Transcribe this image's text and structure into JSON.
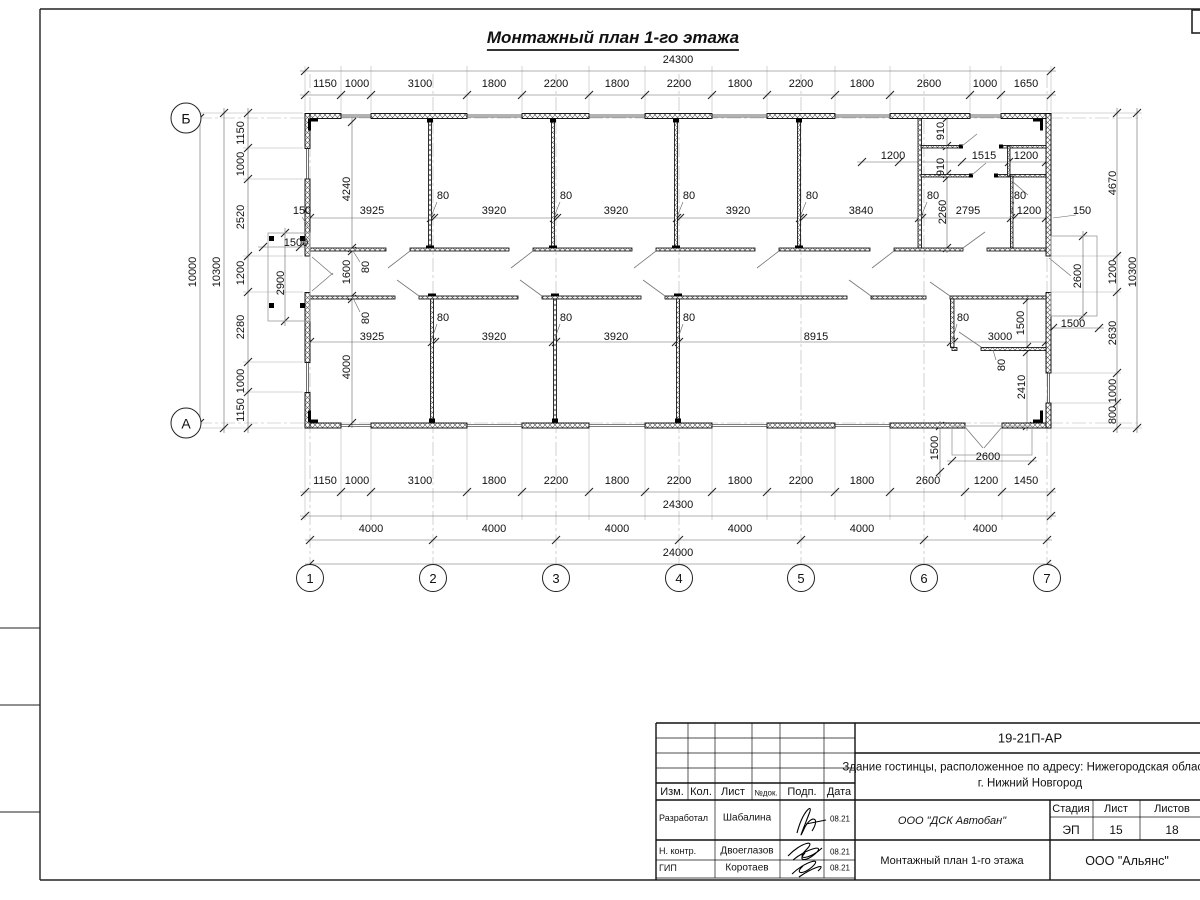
{
  "title": "Монтажный план 1-го этажа",
  "axes": {
    "bottom": [
      {
        "label": "1",
        "x": 310
      },
      {
        "label": "2",
        "x": 433
      },
      {
        "label": "3",
        "x": 556
      },
      {
        "label": "4",
        "x": 679
      },
      {
        "label": "5",
        "x": 801
      },
      {
        "label": "6",
        "x": 924
      },
      {
        "label": "7",
        "x": 1047
      }
    ],
    "left": [
      {
        "label": "Б",
        "y": 118
      },
      {
        "label": "А",
        "y": 423
      }
    ]
  },
  "dim_labels": [
    {
      "t": "24300",
      "x": 678,
      "y": 60,
      "r": 0
    },
    {
      "t": "1150",
      "x": 325,
      "y": 84,
      "r": 0
    },
    {
      "t": "1000",
      "x": 357,
      "y": 84,
      "r": 0
    },
    {
      "t": "3100",
      "x": 420,
      "y": 84,
      "r": 0
    },
    {
      "t": "1800",
      "x": 494,
      "y": 84,
      "r": 0
    },
    {
      "t": "2200",
      "x": 556,
      "y": 84,
      "r": 0
    },
    {
      "t": "1800",
      "x": 617,
      "y": 84,
      "r": 0
    },
    {
      "t": "2200",
      "x": 679,
      "y": 84,
      "r": 0
    },
    {
      "t": "1800",
      "x": 740,
      "y": 84,
      "r": 0
    },
    {
      "t": "2200",
      "x": 801,
      "y": 84,
      "r": 0
    },
    {
      "t": "1800",
      "x": 862,
      "y": 84,
      "r": 0
    },
    {
      "t": "2600",
      "x": 929,
      "y": 84,
      "r": 0
    },
    {
      "t": "1000",
      "x": 985,
      "y": 84,
      "r": 0
    },
    {
      "t": "1650",
      "x": 1026,
      "y": 84,
      "r": 0
    },
    {
      "t": "1150",
      "x": 325,
      "y": 481,
      "r": 0
    },
    {
      "t": "1000",
      "x": 357,
      "y": 481,
      "r": 0
    },
    {
      "t": "3100",
      "x": 420,
      "y": 481,
      "r": 0
    },
    {
      "t": "1800",
      "x": 494,
      "y": 481,
      "r": 0
    },
    {
      "t": "2200",
      "x": 556,
      "y": 481,
      "r": 0
    },
    {
      "t": "1800",
      "x": 617,
      "y": 481,
      "r": 0
    },
    {
      "t": "2200",
      "x": 679,
      "y": 481,
      "r": 0
    },
    {
      "t": "1800",
      "x": 740,
      "y": 481,
      "r": 0
    },
    {
      "t": "2200",
      "x": 801,
      "y": 481,
      "r": 0
    },
    {
      "t": "1800",
      "x": 862,
      "y": 481,
      "r": 0
    },
    {
      "t": "2600",
      "x": 928,
      "y": 481,
      "r": 0
    },
    {
      "t": "1200",
      "x": 986,
      "y": 481,
      "r": 0
    },
    {
      "t": "1450",
      "x": 1026,
      "y": 481,
      "r": 0
    },
    {
      "t": "24300",
      "x": 678,
      "y": 505,
      "r": 0
    },
    {
      "t": "4000",
      "x": 371,
      "y": 529,
      "r": 0
    },
    {
      "t": "4000",
      "x": 494,
      "y": 529,
      "r": 0
    },
    {
      "t": "4000",
      "x": 617,
      "y": 529,
      "r": 0
    },
    {
      "t": "4000",
      "x": 740,
      "y": 529,
      "r": 0
    },
    {
      "t": "4000",
      "x": 862,
      "y": 529,
      "r": 0
    },
    {
      "t": "4000",
      "x": 985,
      "y": 529,
      "r": 0
    },
    {
      "t": "24000",
      "x": 678,
      "y": 553,
      "r": 0
    },
    {
      "t": "1150",
      "x": 241,
      "y": 133,
      "r": 1
    },
    {
      "t": "1000",
      "x": 241,
      "y": 164,
      "r": 1
    },
    {
      "t": "2520",
      "x": 241,
      "y": 217,
      "r": 1
    },
    {
      "t": "1200",
      "x": 241,
      "y": 273,
      "r": 1
    },
    {
      "t": "2280",
      "x": 241,
      "y": 327,
      "r": 1
    },
    {
      "t": "1000",
      "x": 241,
      "y": 381,
      "r": 1
    },
    {
      "t": "1150",
      "x": 241,
      "y": 410,
      "r": 1
    },
    {
      "t": "10300",
      "x": 217,
      "y": 272,
      "r": 1
    },
    {
      "t": "10000",
      "x": 193,
      "y": 272,
      "r": 1
    },
    {
      "t": "4670",
      "x": 1113,
      "y": 183,
      "r": 1
    },
    {
      "t": "1200",
      "x": 1113,
      "y": 272,
      "r": 1
    },
    {
      "t": "2630",
      "x": 1113,
      "y": 333,
      "r": 1
    },
    {
      "t": "1000",
      "x": 1113,
      "y": 391,
      "r": 1
    },
    {
      "t": "800",
      "x": 1113,
      "y": 415,
      "r": 1
    },
    {
      "t": "10300",
      "x": 1133,
      "y": 272,
      "r": 1
    },
    {
      "t": "4240",
      "x": 347,
      "y": 189,
      "r": 1
    },
    {
      "t": "150",
      "x": 302,
      "y": 211,
      "r": 0
    },
    {
      "t": "3925",
      "x": 372,
      "y": 211,
      "r": 0
    },
    {
      "t": "80",
      "x": 443,
      "y": 196,
      "r": 0
    },
    {
      "t": "3920",
      "x": 494,
      "y": 211,
      "r": 0
    },
    {
      "t": "80",
      "x": 566,
      "y": 196,
      "r": 0
    },
    {
      "t": "3920",
      "x": 616,
      "y": 211,
      "r": 0
    },
    {
      "t": "80",
      "x": 689,
      "y": 196,
      "r": 0
    },
    {
      "t": "3920",
      "x": 738,
      "y": 211,
      "r": 0
    },
    {
      "t": "80",
      "x": 812,
      "y": 196,
      "r": 0
    },
    {
      "t": "3840",
      "x": 861,
      "y": 211,
      "r": 0
    },
    {
      "t": "80",
      "x": 933,
      "y": 196,
      "r": 0
    },
    {
      "t": "1200",
      "x": 893,
      "y": 156,
      "r": 0
    },
    {
      "t": "910",
      "x": 941,
      "y": 131,
      "r": 1
    },
    {
      "t": "910",
      "x": 941,
      "y": 167,
      "r": 1
    },
    {
      "t": "1515",
      "x": 984,
      "y": 156,
      "r": 0
    },
    {
      "t": "1200",
      "x": 1026,
      "y": 156,
      "r": 0
    },
    {
      "t": "2260",
      "x": 943,
      "y": 212,
      "r": 1
    },
    {
      "t": "2795",
      "x": 968,
      "y": 211,
      "r": 0
    },
    {
      "t": "80",
      "x": 1020,
      "y": 196,
      "r": 0
    },
    {
      "t": "1200",
      "x": 1029,
      "y": 211,
      "r": 0
    },
    {
      "t": "150",
      "x": 1082,
      "y": 211,
      "r": 0
    },
    {
      "t": "1500",
      "x": 296,
      "y": 243,
      "r": 0
    },
    {
      "t": "2900",
      "x": 281,
      "y": 283,
      "r": 1
    },
    {
      "t": "1600",
      "x": 347,
      "y": 272,
      "r": 1
    },
    {
      "t": "80",
      "x": 366,
      "y": 267,
      "r": 1
    },
    {
      "t": "80",
      "x": 366,
      "y": 318,
      "r": 1
    },
    {
      "t": "4000",
      "x": 347,
      "y": 367,
      "r": 1
    },
    {
      "t": "3925",
      "x": 372,
      "y": 337,
      "r": 0
    },
    {
      "t": "80",
      "x": 443,
      "y": 318,
      "r": 0
    },
    {
      "t": "3920",
      "x": 494,
      "y": 337,
      "r": 0
    },
    {
      "t": "80",
      "x": 566,
      "y": 318,
      "r": 0
    },
    {
      "t": "3920",
      "x": 616,
      "y": 337,
      "r": 0
    },
    {
      "t": "80",
      "x": 689,
      "y": 318,
      "r": 0
    },
    {
      "t": "8915",
      "x": 816,
      "y": 337,
      "r": 0
    },
    {
      "t": "80",
      "x": 963,
      "y": 318,
      "r": 0
    },
    {
      "t": "3000",
      "x": 1000,
      "y": 337,
      "r": 0
    },
    {
      "t": "1500",
      "x": 1021,
      "y": 323,
      "r": 1
    },
    {
      "t": "1500",
      "x": 1073,
      "y": 324,
      "r": 0
    },
    {
      "t": "2600",
      "x": 1078,
      "y": 276,
      "r": 1
    },
    {
      "t": "80",
      "x": 1002,
      "y": 365,
      "r": 1
    },
    {
      "t": "2410",
      "x": 1022,
      "y": 387,
      "r": 1
    },
    {
      "t": "2600",
      "x": 988,
      "y": 457,
      "r": 0
    },
    {
      "t": "1500",
      "x": 935,
      "y": 448,
      "r": 1
    }
  ],
  "title_block": {
    "doc_code": "19-21П-АР",
    "object_name": "Здание гостинцы, расположенное по адресу: Нижегородская область, г. Нижний Новгород",
    "col_izm": "Изм.",
    "col_kol": "Кол.",
    "col_list": "Лист",
    "col_doc": "№док.",
    "col_podp": "Подп.",
    "col_data": "Дата",
    "row1_role": "Разработал",
    "row1_name": "Шабалина",
    "row1_date": "08.21",
    "row2_role": "Н. контр.",
    "row2_name": "Двоеглазов",
    "row2_date": "08.21",
    "row3_role": "ГИП",
    "row3_name": "Коротаев",
    "row3_date": "08.21",
    "org": "ООО \"ДСК Автобан\"",
    "stage_label": "Стадия",
    "sheet_label": "Лист",
    "sheets_label": "Листов",
    "stage": "ЭП",
    "sheet": "15",
    "sheets": "18",
    "plan_name": "Монтажный план 1-го этажа",
    "company": "ООО \"Альянс\""
  }
}
